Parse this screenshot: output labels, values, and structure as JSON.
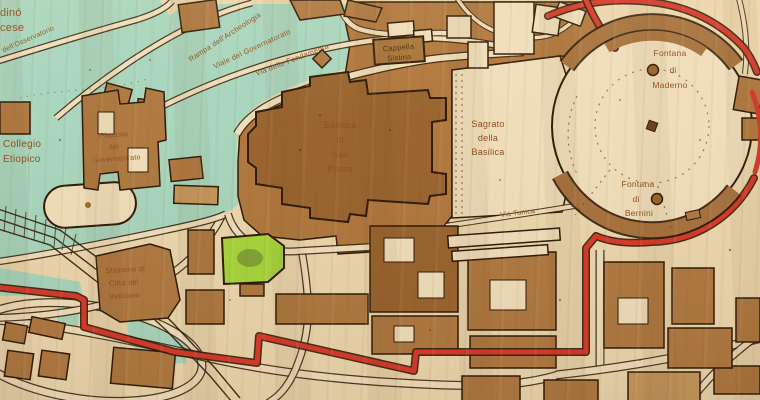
{
  "title": "Laser-engraved wooden map of Vatican City — St. Peter's Basilica and Square",
  "palette": {
    "wood_pale": "#ecd7ae",
    "cream": "#f0debb",
    "core": "#b1793f",
    "basilica": "#9a6530",
    "building": "#b07a42",
    "building_light": "#c7995f",
    "green": "#a9d6bd",
    "bright_green": "#a8d63e",
    "red": "#d93a2b",
    "outline": "#301c08",
    "text": "#8f5220",
    "text_dark": "#53300e"
  },
  "labels": {
    "giardino_fragment": "dinó",
    "francese_fragment": "cese",
    "cappella": {
      "lines": [
        "Cappella",
        "Sistina"
      ]
    },
    "basilica": {
      "lines": [
        "Basilica",
        "di",
        "San",
        "Pietro"
      ]
    },
    "sagrato": {
      "lines": [
        "Sagrato",
        "della",
        "Basilica"
      ]
    },
    "maderno": {
      "lines": [
        "Fontana",
        "di",
        "Maderno"
      ]
    },
    "bernini": {
      "lines": [
        "Fontana",
        "di",
        "Bernini"
      ]
    },
    "collegio": {
      "lines": [
        "Collegio",
        "Etiopico"
      ]
    },
    "piazzale": {
      "lines": [
        "Piazzale",
        "del",
        "Governatorato"
      ]
    },
    "stazione": {
      "lines": [
        "Stazione di",
        "Città del",
        "Vaticano"
      ]
    }
  },
  "streets": {
    "osservatorio": "dell'Osservatorio",
    "rampa": "Rampa dell'Archeologia",
    "viale": "Viale del Governatorato",
    "fondamenta": "Via delle Fondamenta",
    "tunica": "Via Tunica"
  }
}
